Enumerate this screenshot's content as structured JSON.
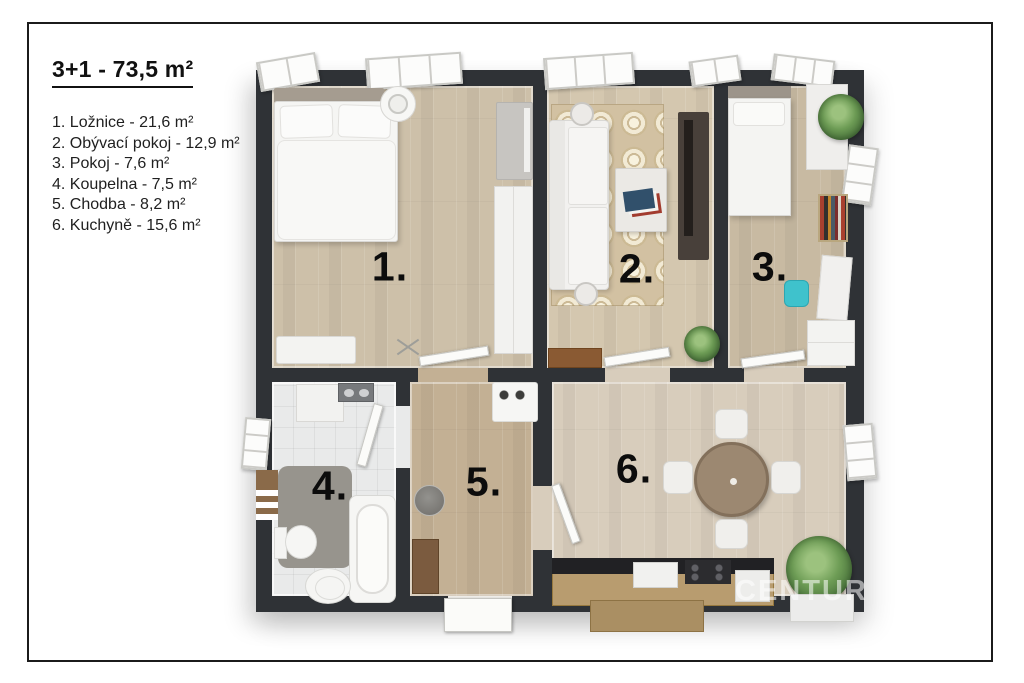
{
  "legend": {
    "title": "3+1 - 73,5 m²",
    "items": [
      "1. Ložnice - 21,6 m²",
      "2. Obývací pokoj - 12,9 m²",
      "3. Pokoj - 7,6 m²",
      "4. Koupelna - 7,5 m²",
      "5. Chodba - 8,2 m²",
      "6. Kuchyně - 15,6 m²"
    ]
  },
  "floorplan": {
    "rooms": [
      {
        "label": "1.",
        "name": "Ložnice",
        "area_m2": "21,6"
      },
      {
        "label": "2.",
        "name": "Obývací pokoj",
        "area_m2": "12,9"
      },
      {
        "label": "3.",
        "name": "Pokoj",
        "area_m2": "7,6"
      },
      {
        "label": "4.",
        "name": "Koupelna",
        "area_m2": "7,5"
      },
      {
        "label": "5.",
        "name": "Chodba",
        "area_m2": "8,2"
      },
      {
        "label": "6.",
        "name": "Kuchyně",
        "area_m2": "15,6"
      }
    ],
    "watermark": "CENTUR"
  },
  "colors": {
    "wall": "#2f3236",
    "wood_bedroom": "#cdc0a9",
    "wood_living": "#d4c7af",
    "wood_room3": "#c8baa2",
    "wood_hall": "#c3b094",
    "wood_kitchen": "#d8cdbc",
    "tile_bath": "#e9eaea",
    "accent_chair": "#3fc2cc"
  }
}
